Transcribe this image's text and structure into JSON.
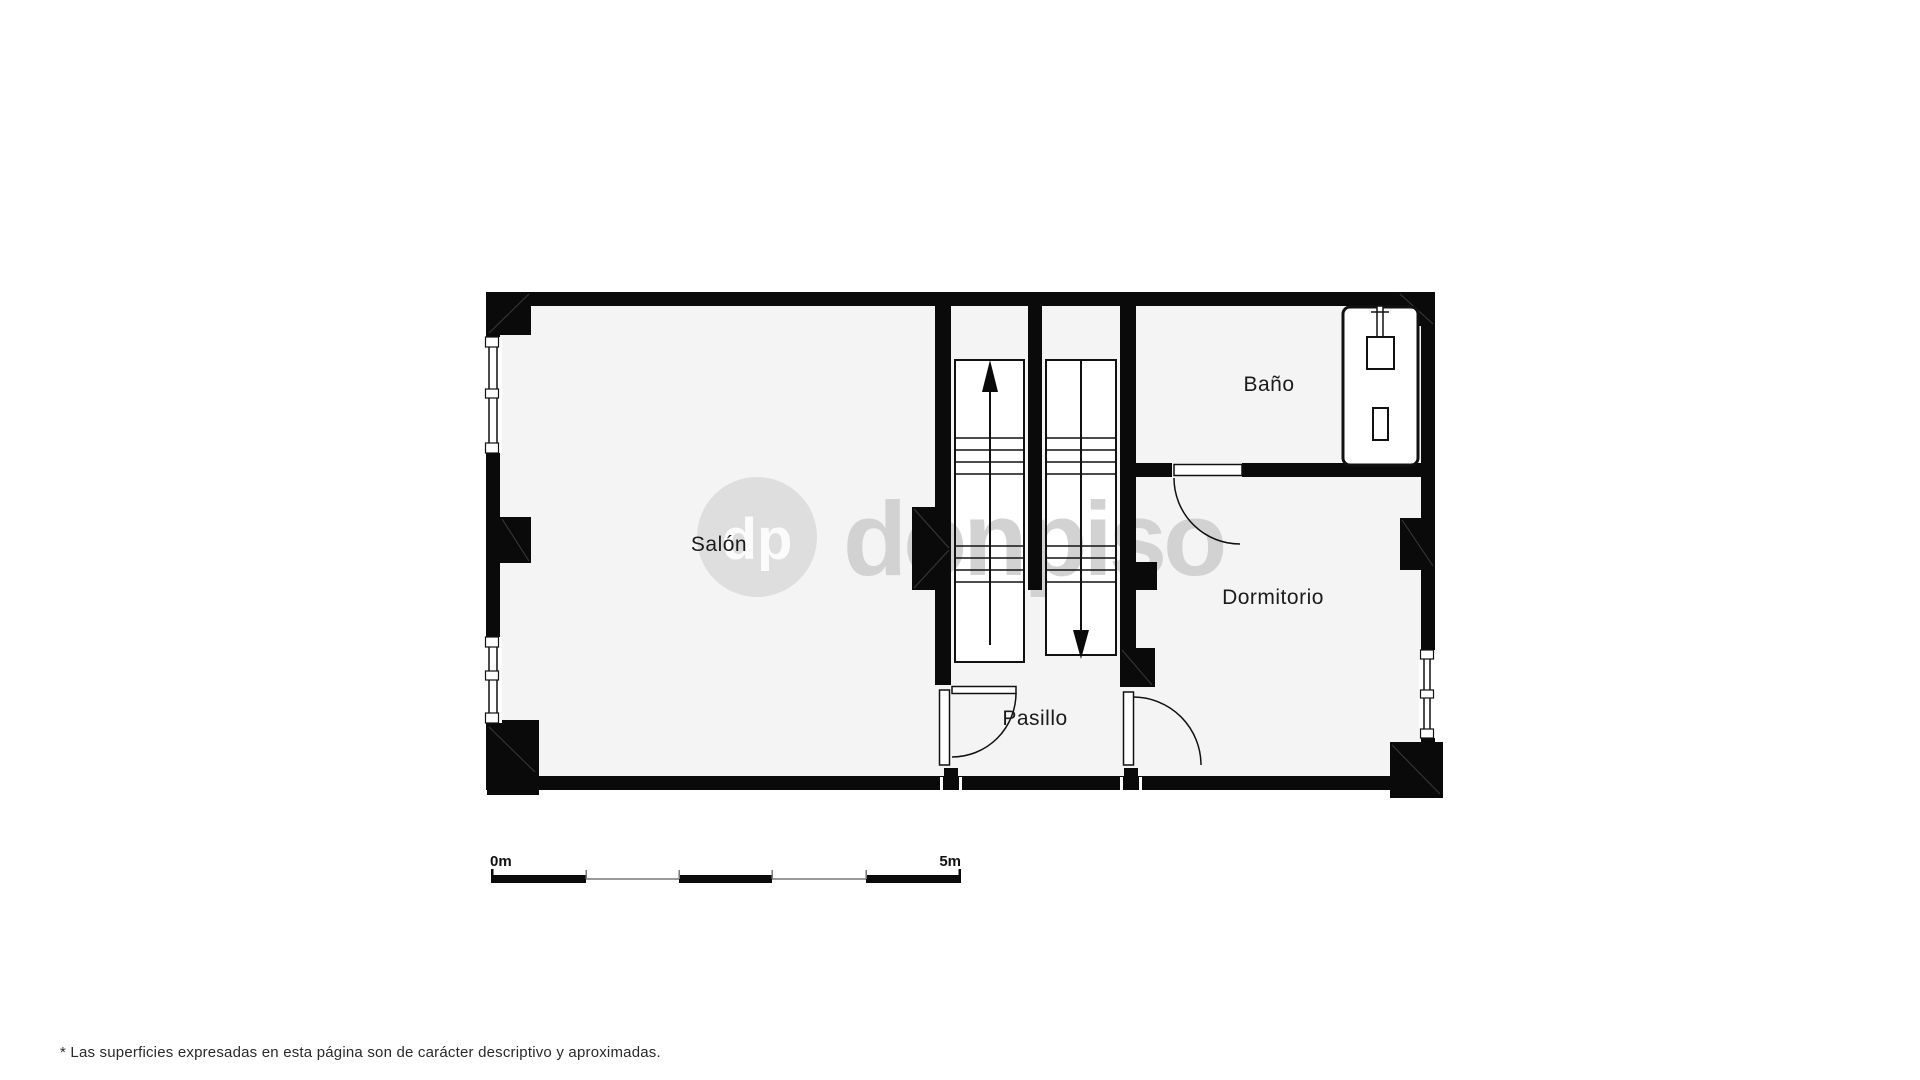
{
  "rooms": {
    "salon": {
      "label": "Salón"
    },
    "bano": {
      "label": "Baño"
    },
    "dormitorio": {
      "label": "Dormitorio"
    },
    "pasillo": {
      "label": "Pasillo"
    }
  },
  "watermark": {
    "initials": "dp",
    "brand": "donpiso"
  },
  "scale_bar": {
    "start": "0m",
    "end": "5m"
  },
  "footnote": {
    "text": "* Las superficies expresadas en esta página son de carácter descriptivo y aproximadas."
  },
  "colors": {
    "wall": "#0a0a0a",
    "room_fill": "#f4f4f4",
    "stair_fill": "#ffffff",
    "watermark_circle": "#dedede",
    "watermark_initials": "#fbfbfb",
    "watermark_brand": "#d2d2d2",
    "scale_line": "#9a9a9a",
    "page_background": "#ffffff"
  }
}
